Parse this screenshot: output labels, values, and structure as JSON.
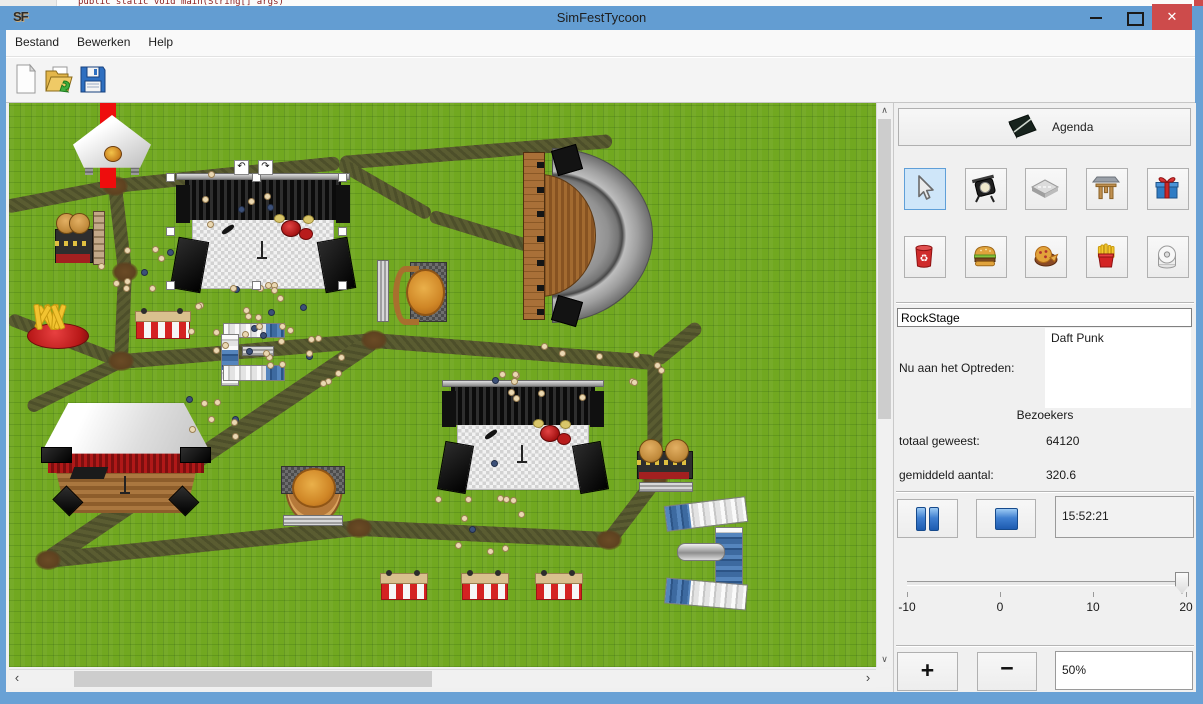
{
  "background_app": {
    "code_line": "public static void main(String[] args)"
  },
  "window": {
    "title": "SimFestTycoon",
    "icon_text": "SF",
    "controls": {
      "minimize": "–",
      "close": "✕"
    }
  },
  "menu": {
    "items": [
      "Bestand",
      "Bewerken",
      "Help"
    ]
  },
  "toolbar": {
    "buttons": [
      {
        "name": "new-file"
      },
      {
        "name": "open-file"
      },
      {
        "name": "save-file"
      }
    ]
  },
  "panel": {
    "agenda_button": "Agenda",
    "tools": [
      {
        "icon": "cursor",
        "selected": true
      },
      {
        "icon": "spotlight",
        "selected": false
      },
      {
        "icon": "road-tile",
        "selected": false
      },
      {
        "icon": "gate",
        "selected": false
      },
      {
        "icon": "gift",
        "selected": false
      },
      {
        "icon": "trash-can",
        "selected": false
      },
      {
        "icon": "burger",
        "selected": false
      },
      {
        "icon": "pizza",
        "selected": false
      },
      {
        "icon": "fries",
        "selected": false
      },
      {
        "icon": "toilet-roll",
        "selected": false
      }
    ],
    "stage_name_field": "RockStage",
    "now_performing_label": "Nu aan het Optreden:",
    "now_performing_value": "Daft Punk",
    "visitors_header": "Bezoekers",
    "visitors_total_label": "totaal geweest:",
    "visitors_total_value": "64120",
    "visitors_average_label": "gemiddeld aantal:",
    "visitors_average_value": "320.6",
    "clock_value": "15:52:21",
    "speed_slider": {
      "min": -10,
      "max": 20,
      "value": 20,
      "tick_labels": [
        "-10",
        "0",
        "10",
        "20"
      ]
    },
    "zoom_in_label": "+",
    "zoom_out_label": "−",
    "zoom_value": "50%"
  },
  "map": {
    "selected_object": "RockStage",
    "paths": [
      [
        -4,
        104,
        106,
        83,
        14
      ],
      [
        106,
        83,
        331,
        60,
        14
      ],
      [
        331,
        60,
        603,
        38,
        14
      ],
      [
        106,
        83,
        116,
        169,
        14
      ],
      [
        116,
        169,
        112,
        258,
        14
      ],
      [
        112,
        258,
        0,
        215,
        13
      ],
      [
        112,
        258,
        19,
        305,
        13
      ],
      [
        112,
        258,
        365,
        237,
        15
      ],
      [
        365,
        237,
        646,
        259,
        15
      ],
      [
        646,
        259,
        691,
        222,
        14
      ],
      [
        365,
        237,
        39,
        457,
        18
      ],
      [
        39,
        457,
        350,
        425,
        16
      ],
      [
        350,
        425,
        600,
        437,
        16
      ],
      [
        600,
        437,
        646,
        377,
        15
      ],
      [
        646,
        377,
        646,
        259,
        15
      ],
      [
        331,
        60,
        421,
        112,
        13
      ],
      [
        421,
        112,
        528,
        145,
        13
      ]
    ],
    "junctions": [
      [
        106,
        83
      ],
      [
        116,
        169
      ],
      [
        112,
        258
      ],
      [
        365,
        237
      ],
      [
        39,
        457
      ],
      [
        350,
        425
      ],
      [
        600,
        437
      ],
      [
        646,
        377
      ]
    ],
    "objects": [
      {
        "type": "redstripe",
        "rect": [
          91,
          0,
          16,
          85
        ]
      },
      {
        "type": "tent",
        "rect": [
          64,
          12,
          78,
          60
        ]
      },
      {
        "type": "burgerstand",
        "rect": [
          46,
          110,
          36,
          50
        ]
      },
      {
        "type": "counter",
        "rect": [
          84,
          108,
          10,
          52
        ]
      },
      {
        "type": "rockstage",
        "rect": [
          163,
          70,
          182,
          118
        ]
      },
      {
        "type": "amphitheater",
        "rect": [
          514,
          45,
          130,
          175
        ]
      },
      {
        "type": "fries",
        "rect": [
          18,
          200,
          60,
          46
        ]
      },
      {
        "type": "stand",
        "rect": [
          126,
          208,
          54,
          28
        ]
      },
      {
        "type": "containers",
        "rect": [
          214,
          220,
          60,
          13
        ],
        "dir": "h",
        "blue": "end"
      },
      {
        "type": "containers",
        "rect": [
          212,
          231,
          16,
          50
        ],
        "dir": "v",
        "blue": "mid"
      },
      {
        "type": "containers",
        "rect": [
          214,
          262,
          60,
          14
        ],
        "dir": "h",
        "blue": "end"
      },
      {
        "type": "bench",
        "rect": [
          233,
          243,
          30,
          8
        ]
      },
      {
        "type": "bench",
        "rect": [
          368,
          157,
          10,
          60
        ],
        "vert": true
      },
      {
        "type": "pizzaround",
        "rect": [
          380,
          155,
          56,
          66
        ]
      },
      {
        "type": "bigstage",
        "rect": [
          32,
          300,
          170,
          110
        ]
      },
      {
        "type": "pizzastand",
        "rect": [
          272,
          363,
          62,
          58
        ]
      },
      {
        "type": "bench",
        "rect": [
          274,
          412,
          58,
          9
        ]
      },
      {
        "type": "rockstage",
        "rect": [
          430,
          277,
          168,
          112
        ]
      },
      {
        "type": "burgerstand",
        "rect": [
          628,
          336,
          54,
          40
        ]
      },
      {
        "type": "bench",
        "rect": [
          630,
          379,
          52,
          8
        ]
      },
      {
        "type": "containers",
        "rect": [
          656,
          398,
          80,
          24
        ],
        "dir": "h",
        "blue": "start",
        "tilt": -7
      },
      {
        "type": "containers",
        "rect": [
          706,
          424,
          26,
          62
        ],
        "dir": "v",
        "blue": "all"
      },
      {
        "type": "containers",
        "rect": [
          656,
          478,
          80,
          24
        ],
        "dir": "h",
        "blue": "start",
        "tilt": 5
      },
      {
        "type": "pipes",
        "rect": [
          668,
          440,
          46,
          16
        ]
      },
      {
        "type": "stand",
        "rect": [
          371,
          470,
          46,
          27
        ]
      },
      {
        "type": "stand",
        "rect": [
          452,
          470,
          46,
          27
        ]
      },
      {
        "type": "stand",
        "rect": [
          526,
          470,
          46,
          27
        ]
      }
    ],
    "crowds": [
      {
        "cx": 240,
        "cy": 215,
        "r": 58,
        "n": 26
      },
      {
        "cx": 130,
        "cy": 158,
        "r": 38,
        "n": 10
      },
      {
        "cx": 292,
        "cy": 252,
        "r": 40,
        "n": 12
      },
      {
        "cx": 540,
        "cy": 268,
        "r": 55,
        "n": 12
      },
      {
        "cx": 628,
        "cy": 262,
        "r": 22,
        "n": 5
      },
      {
        "cx": 470,
        "cy": 395,
        "r": 80,
        "n": 12
      },
      {
        "cx": 200,
        "cy": 300,
        "r": 48,
        "n": 8
      },
      {
        "cx": 215,
        "cy": 95,
        "r": 45,
        "n": 7
      }
    ],
    "selection": {
      "box": [
        161,
        74,
        172,
        108
      ],
      "rotate_icons": [
        "↶",
        "↷"
      ]
    }
  },
  "colors": {
    "titlebar": "#639dd2",
    "close_button": "#cd4b4b",
    "grass": "#71a820",
    "path": "#5a5c31",
    "selection_fill": "#cfe6f9",
    "selection_border": "#5f9fd8"
  }
}
